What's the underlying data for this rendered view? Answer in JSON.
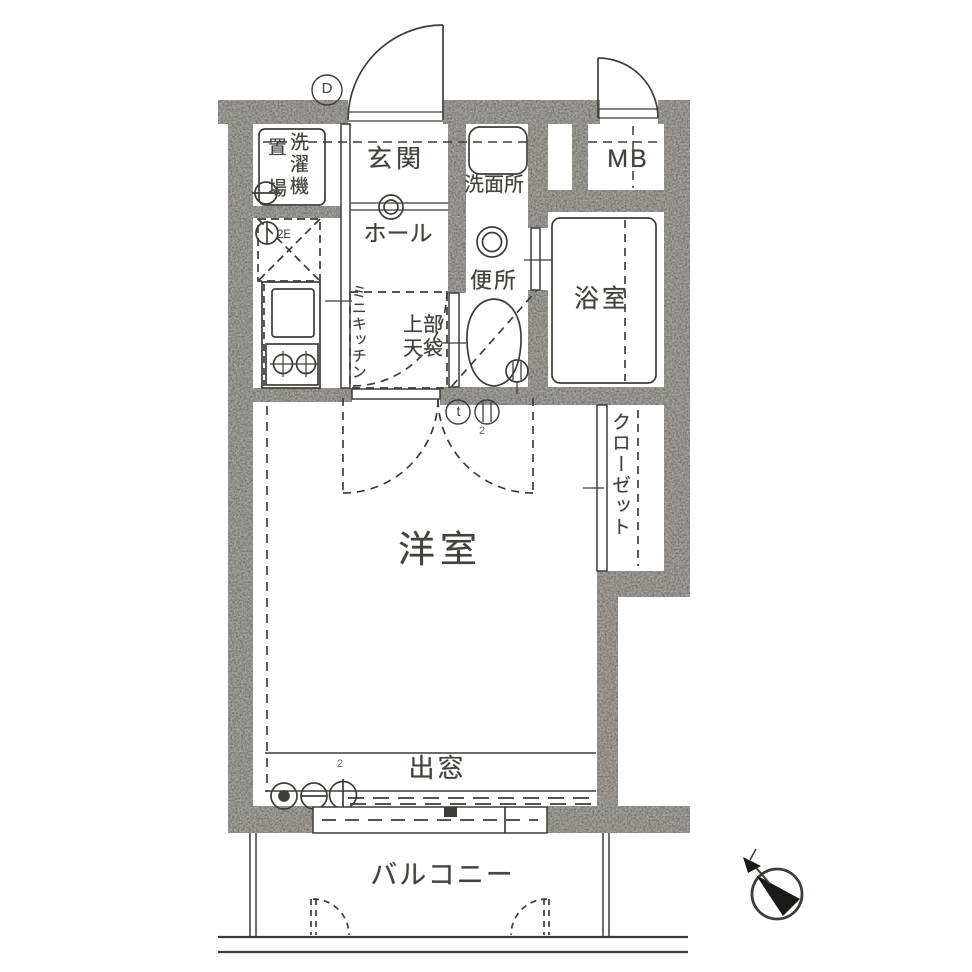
{
  "plan": {
    "rooms": {
      "entrance": "玄関",
      "hall": "ホール",
      "washroom": "洗面所",
      "toilet": "便所",
      "bathroom": "浴室",
      "meter_box": "MB",
      "laundry_col_right": "洗濯機",
      "laundry_col_left": "置場",
      "mini_kitchen": "ミニキッチン",
      "upper_cabinet_line1": "上部",
      "upper_cabinet_line2": "天袋",
      "closet": "クローゼット",
      "western_room": "洋室",
      "bay_window": "出窓",
      "balcony": "バルコニー"
    },
    "marks": {
      "entrance_door": "D",
      "refrigerator": "2E",
      "thermostat": "t",
      "outlet_hall_count": "2",
      "outlet_window_count": "2"
    },
    "colors": {
      "wall": "#55504a",
      "line": "#3f3c38",
      "text": "#44403b",
      "background": "#ffffff"
    }
  }
}
